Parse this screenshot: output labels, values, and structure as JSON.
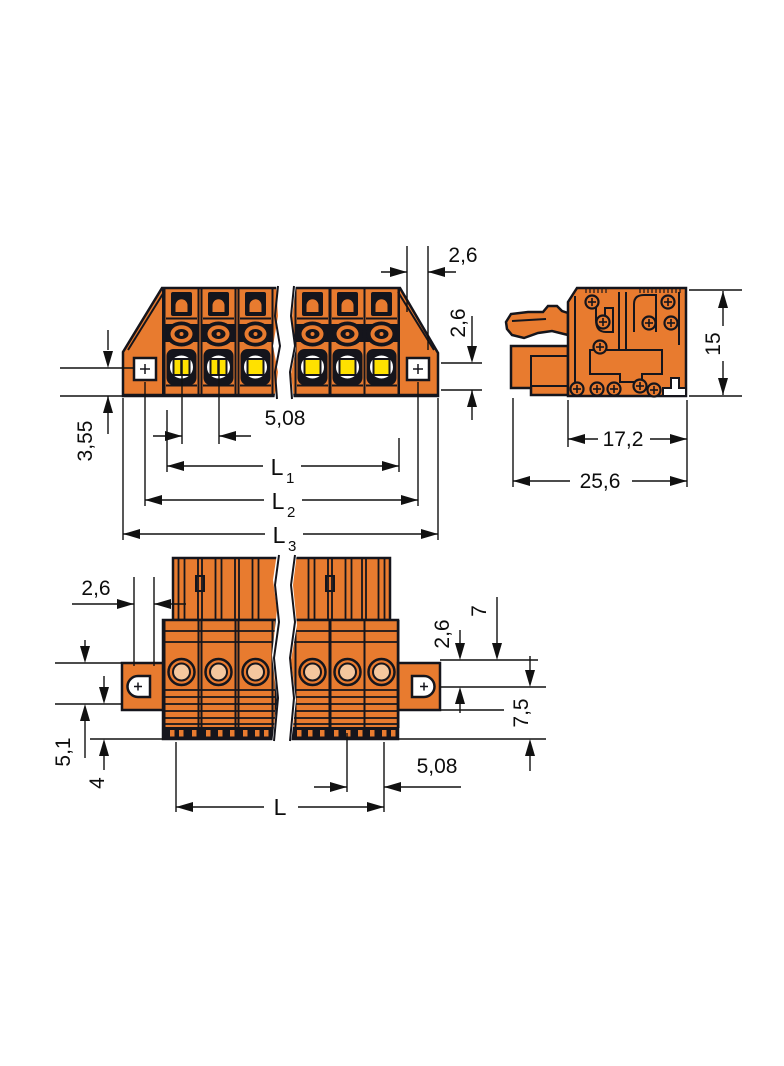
{
  "page": {
    "background": "#ffffff",
    "description": "Technical dimension drawing of an orange multi-pole female plug connector with mounting flanges, shown in three orthographic views with a break symbol for variable pole count"
  },
  "colors": {
    "housing_orange": "#E87B2F",
    "outline_dark": "#15151C",
    "contact_window_yellow": "#FFE100",
    "hole_inner_peach": "#F4C79E",
    "dimension_ink": "#111111",
    "paper_white": "#FFFFFF"
  },
  "views": {
    "front": {
      "labels": {
        "top_offset": "2,6",
        "right_offset": "2,6",
        "flange_hole_height": "3,55",
        "pole_pitch": "5,08",
        "l1": "L",
        "l1_sub": "1",
        "l2": "L",
        "l2_sub": "2",
        "l3": "L",
        "l3_sub": "3"
      }
    },
    "side": {
      "labels": {
        "height": "15",
        "housing_depth": "17,2",
        "overall_depth": "25,6"
      }
    },
    "bottom": {
      "labels": {
        "slot_width": "2,6",
        "flange_span": "7",
        "flange_offset": "2,6",
        "rear_depth": "7,5",
        "flange_height": "5,1",
        "foot_depth": "4",
        "pole_pitch": "5,08",
        "length": "L"
      }
    }
  }
}
